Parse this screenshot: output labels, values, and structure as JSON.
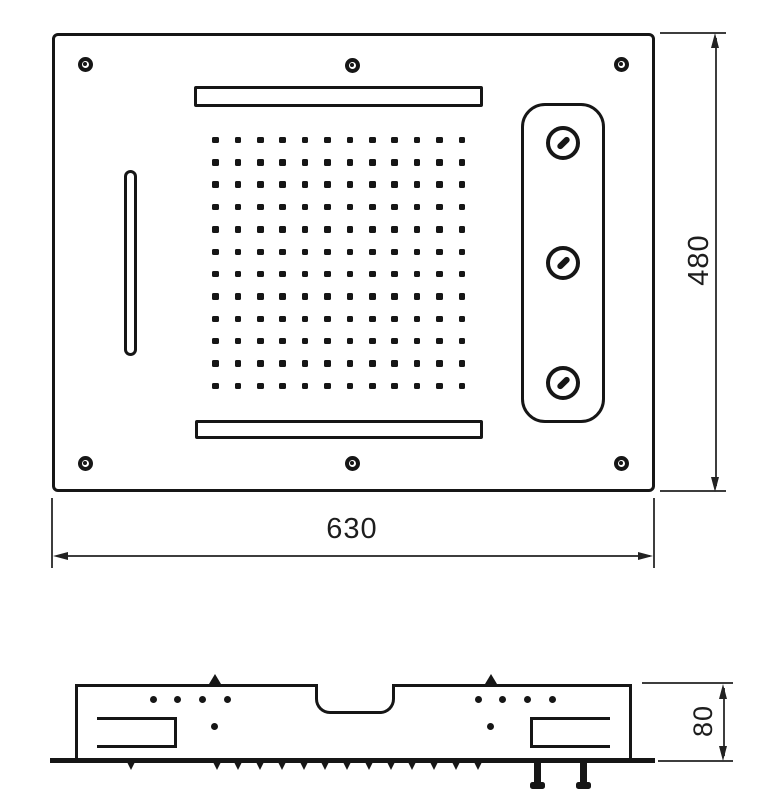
{
  "drawing": {
    "title": "recessed-shower-head-technical-drawing",
    "colors": {
      "line": "#161616",
      "dim_line": "#3d3d3d",
      "background": "#ffffff"
    },
    "top_view": {
      "width_label": "630",
      "height_label": "480",
      "nozzle_grid": {
        "rows": 12,
        "cols": 12
      },
      "screw_holes": 6,
      "body_jets": 3,
      "waterfall_slots": 2,
      "side_slots": 1
    },
    "side_view": {
      "height_label": "80",
      "nozzle_teeth": 13,
      "inlet_pegs": 2,
      "mount_bumps": 2,
      "top_dots": 8,
      "low_dots": 2
    }
  }
}
